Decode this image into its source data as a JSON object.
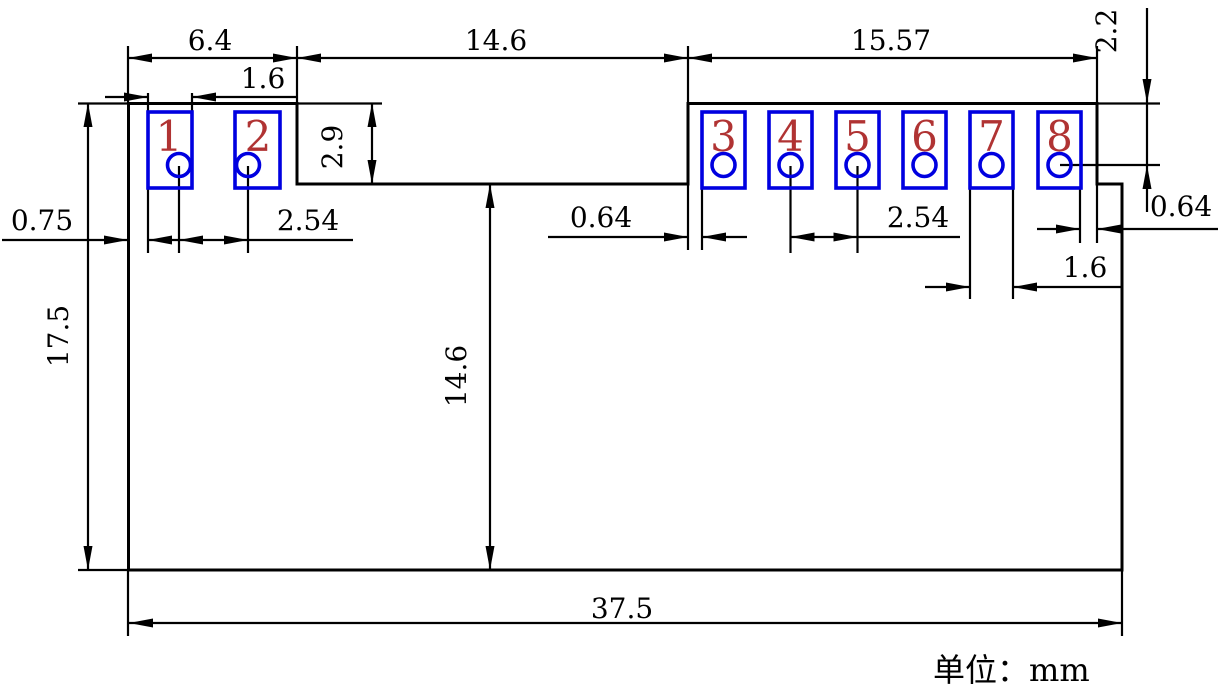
{
  "drawing": {
    "pads": [
      {
        "number": "1"
      },
      {
        "number": "2"
      },
      {
        "number": "3"
      },
      {
        "number": "4"
      },
      {
        "number": "5"
      },
      {
        "number": "6"
      },
      {
        "number": "7"
      },
      {
        "number": "8"
      }
    ],
    "dimensions": {
      "top_width_left": "6.4",
      "pad1_width": "1.6",
      "top_notch_width": "14.6",
      "top_width_right": "15.57",
      "notch_depth": "2.9",
      "top_edge_to_hole": "2.2",
      "left_edge_to_pad": "0.75",
      "hole_pitch_left": "2.54",
      "step_to_pad3": "0.64",
      "hole_pitch_right": "2.54",
      "pad8_to_edge": "0.64",
      "pad7_width": "1.6",
      "board_height": "17.5",
      "notch_to_bottom": "14.6",
      "board_width": "37.5"
    },
    "unit_note": "单位：mm",
    "colors": {
      "line": "#000000",
      "pad_outline": "#0000e0",
      "pad_number": "#b03333",
      "background": "#ffffff"
    }
  }
}
